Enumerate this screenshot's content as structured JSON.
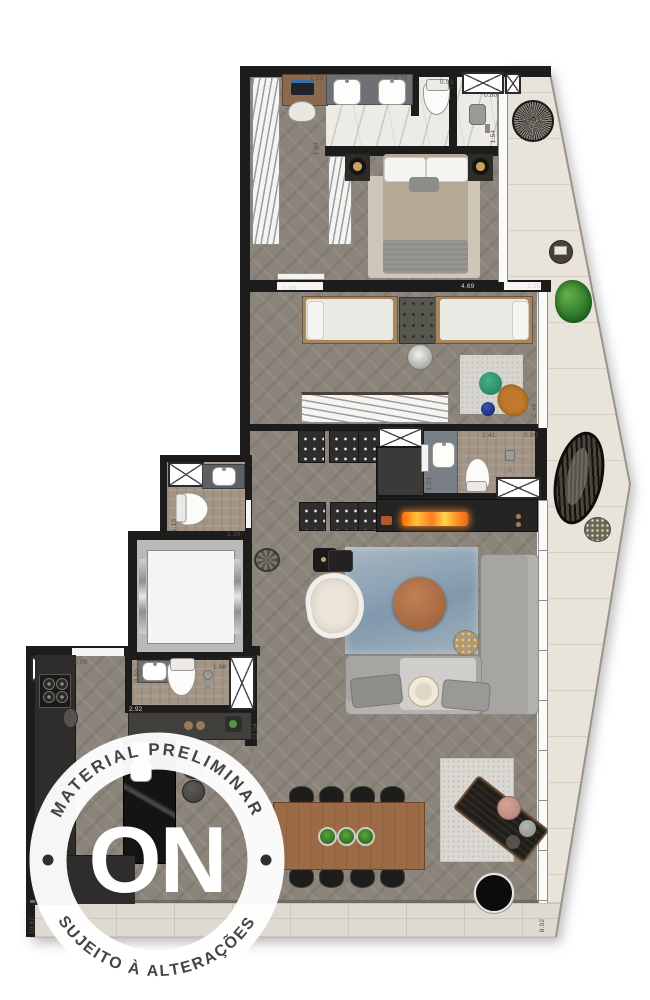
{
  "watermark": {
    "arc_top": "MATERIAL PRELIMINAR",
    "logo": "ON",
    "arc_bottom": "SUJEITO À ALTERAÇÕES"
  },
  "dims": {
    "vanity_width": "1.53",
    "sink_counter_width": "1.72",
    "wc_width": "0.93",
    "shower_width": "0.80",
    "shower_length": "1.54",
    "closet_depth": "1.64",
    "suite_door": "0.96",
    "suite_width": "4.69",
    "balcony_door": "1.25",
    "bath2_width": "1.41",
    "bath2_niche": "0.90",
    "bath2_length": "1.21",
    "balcony_width": "2.48",
    "bath3_length": "1.13",
    "bath3_width": "1.39",
    "service_niche": "1.09",
    "lavabo_width": "1.96",
    "lavabo_length": "0.90",
    "kitchen_width": "2.92",
    "hall_length": "11.04",
    "kitchen_length": "10.67",
    "terrace_length": "8.92"
  },
  "colors": {
    "wall": "#1c1c1c",
    "wood_floor": "#8b847b",
    "marble": "#edebe5",
    "tile_taupe": "#a39585",
    "balcony_floor": "#e9e4db",
    "accent_orange": "#c07a2e",
    "accent_green": "#3f8f35",
    "rug_blue": "#93a7b8",
    "sofa_gray": "#a6a5a1",
    "dining_wood": "#9c6a44",
    "flame": "#ff8a25"
  }
}
